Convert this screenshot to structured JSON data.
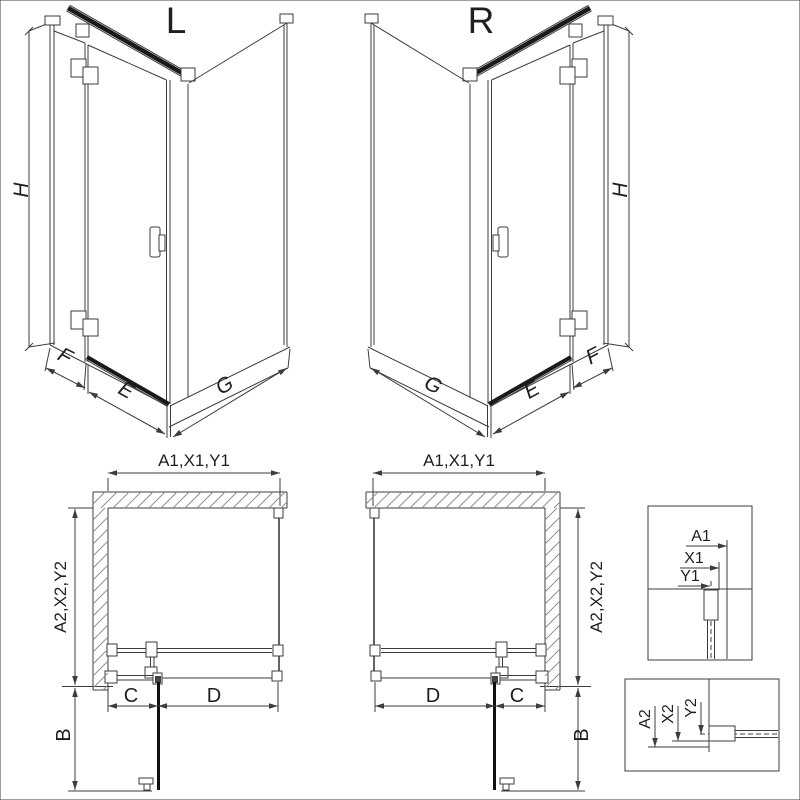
{
  "diagram": {
    "background": "#ffffff",
    "line_color": "#3c3c3c",
    "dark_color": "#1a1a1a",
    "hatch_color": "#8a8a8a",
    "iso_left": {
      "variant": "L",
      "height": "H",
      "fixed_width": "F",
      "door_width": "E",
      "side_width": "G"
    },
    "iso_right": {
      "variant": "R",
      "height": "H",
      "fixed_width": "F",
      "door_width": "E",
      "side_width": "G"
    },
    "plan_left": {
      "width_dims": "A1,X1,Y1",
      "depth_dims": "A2,X2,Y2",
      "door_open": "B",
      "fixed_segment": "C",
      "door_segment": "D"
    },
    "plan_right": {
      "width_dims": "A1,X1,Y1",
      "depth_dims": "A2,X2,Y2",
      "door_open": "B",
      "fixed_segment": "C",
      "door_segment": "D"
    },
    "detail_width": {
      "a": "A1",
      "x": "X1",
      "y": "Y1"
    },
    "detail_depth": {
      "a": "A2",
      "x": "X2",
      "y": "Y2"
    }
  }
}
